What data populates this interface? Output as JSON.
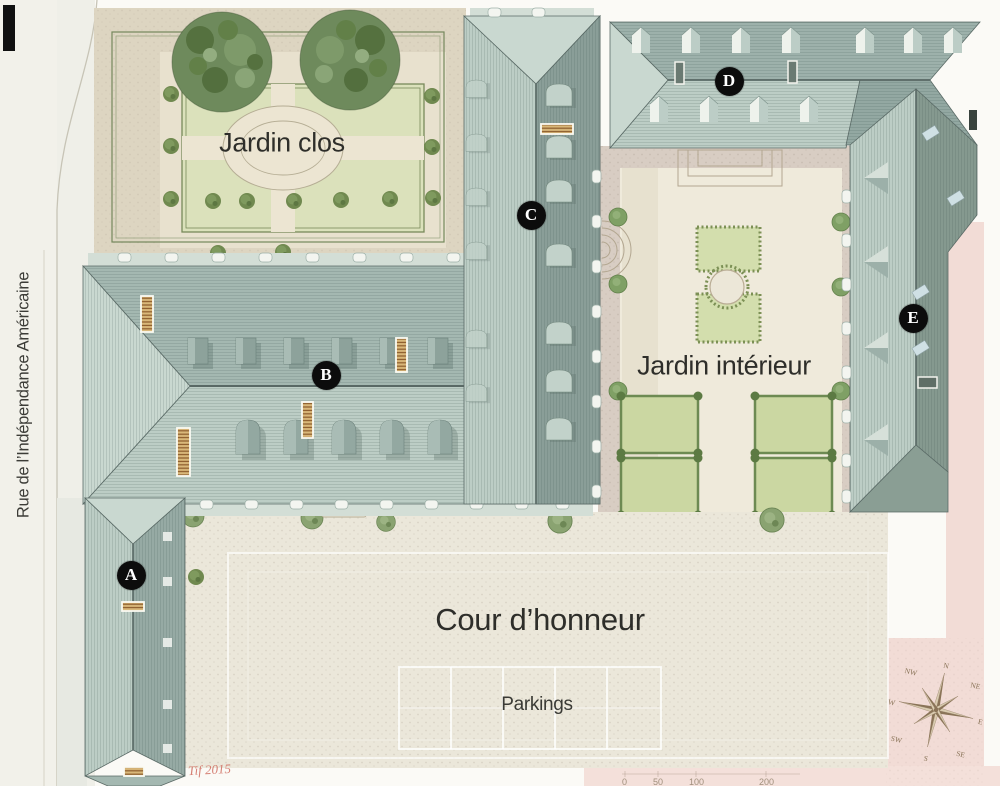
{
  "labels": {
    "jardin_clos": "Jardin clos",
    "jardin_interieur": "Jardin intérieur",
    "cour_honneur": "Cour d’honneur",
    "parkings": "Parkings",
    "street": "Rue de l’Indépendance Américaine"
  },
  "markers": [
    {
      "label": "A"
    },
    {
      "label": "B"
    },
    {
      "label": "C"
    },
    {
      "label": "D"
    },
    {
      "label": "E"
    }
  ],
  "compass": {
    "directions": [
      "N",
      "NE",
      "E",
      "SE",
      "S",
      "SW",
      "W",
      "NW"
    ]
  },
  "scale_bar": {
    "labels": [
      "0",
      "50",
      "100",
      "200"
    ]
  },
  "signature": "Tif 2015",
  "colors": {
    "roof_light": "#bccdc5",
    "roof_mid": "#a4b8b1",
    "roof_dark": "#8fa49d",
    "lawn": "#dbe1bb",
    "gravel": "#ebe7da",
    "street_pink": "#f2dcd6",
    "hedge": "#74885c",
    "marker_bg": "#0c0c0c",
    "signature_red": "#cf6b5e",
    "compass_sepia": "#8a7458"
  }
}
